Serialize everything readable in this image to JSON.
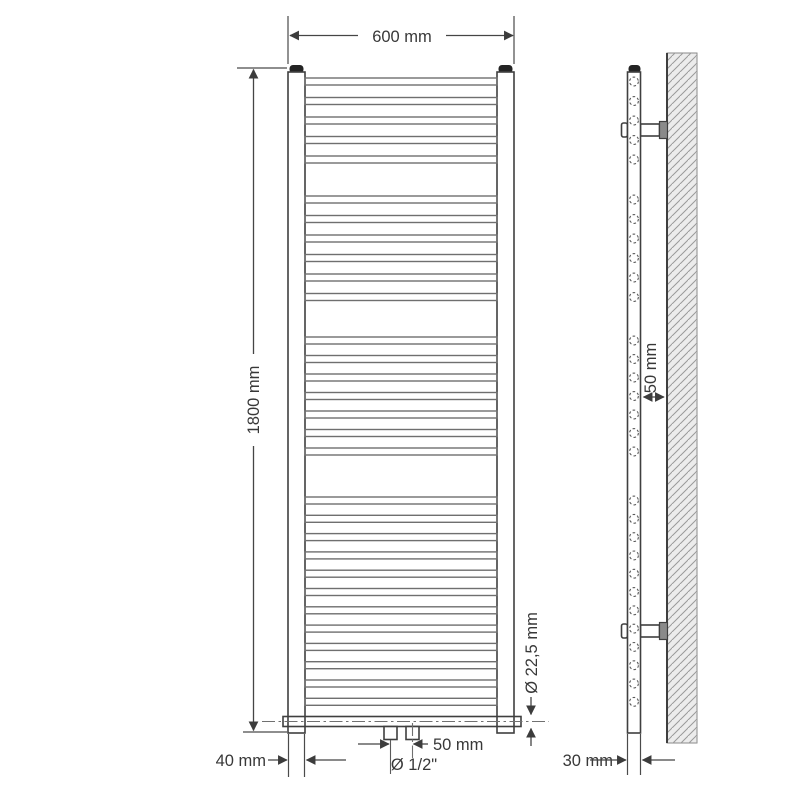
{
  "diagram": {
    "type": "technical-drawing",
    "subject": "heated towel rail radiator - dimensional drawing, front view and side view with wall mounting",
    "labels": {
      "width": "600 mm",
      "height": "1800 mm",
      "foot_width": "40 mm",
      "connection_spacing": "50 mm",
      "connection_thread": "Ø 1/2\"",
      "tube_diameter": "Ø 22,5 mm",
      "wall_distance": "50 mm",
      "profile_depth": "30 mm"
    },
    "colors": {
      "line": "#3f3f3f",
      "dimension_line": "#4a4a4a",
      "rung_line": "#6f6f6f",
      "wall_fill": "#ececec",
      "hatch": "#9a9a9a",
      "cap": "#242424",
      "bracket_plate": "#8a8a8a",
      "background": "#ffffff"
    },
    "front_rungs": {
      "x": 305,
      "width": 192,
      "height": 7,
      "groups": [
        {
          "y": 78,
          "count": 5,
          "pitch": 19.5
        },
        {
          "y": 196,
          "count": 6,
          "pitch": 19.5
        },
        {
          "y": 337,
          "count": 7,
          "pitch": 18.5
        },
        {
          "y": 497,
          "count": 12,
          "pitch": 18.3
        }
      ]
    },
    "side_circles": {
      "cx": 634,
      "r": 4.4
    }
  }
}
